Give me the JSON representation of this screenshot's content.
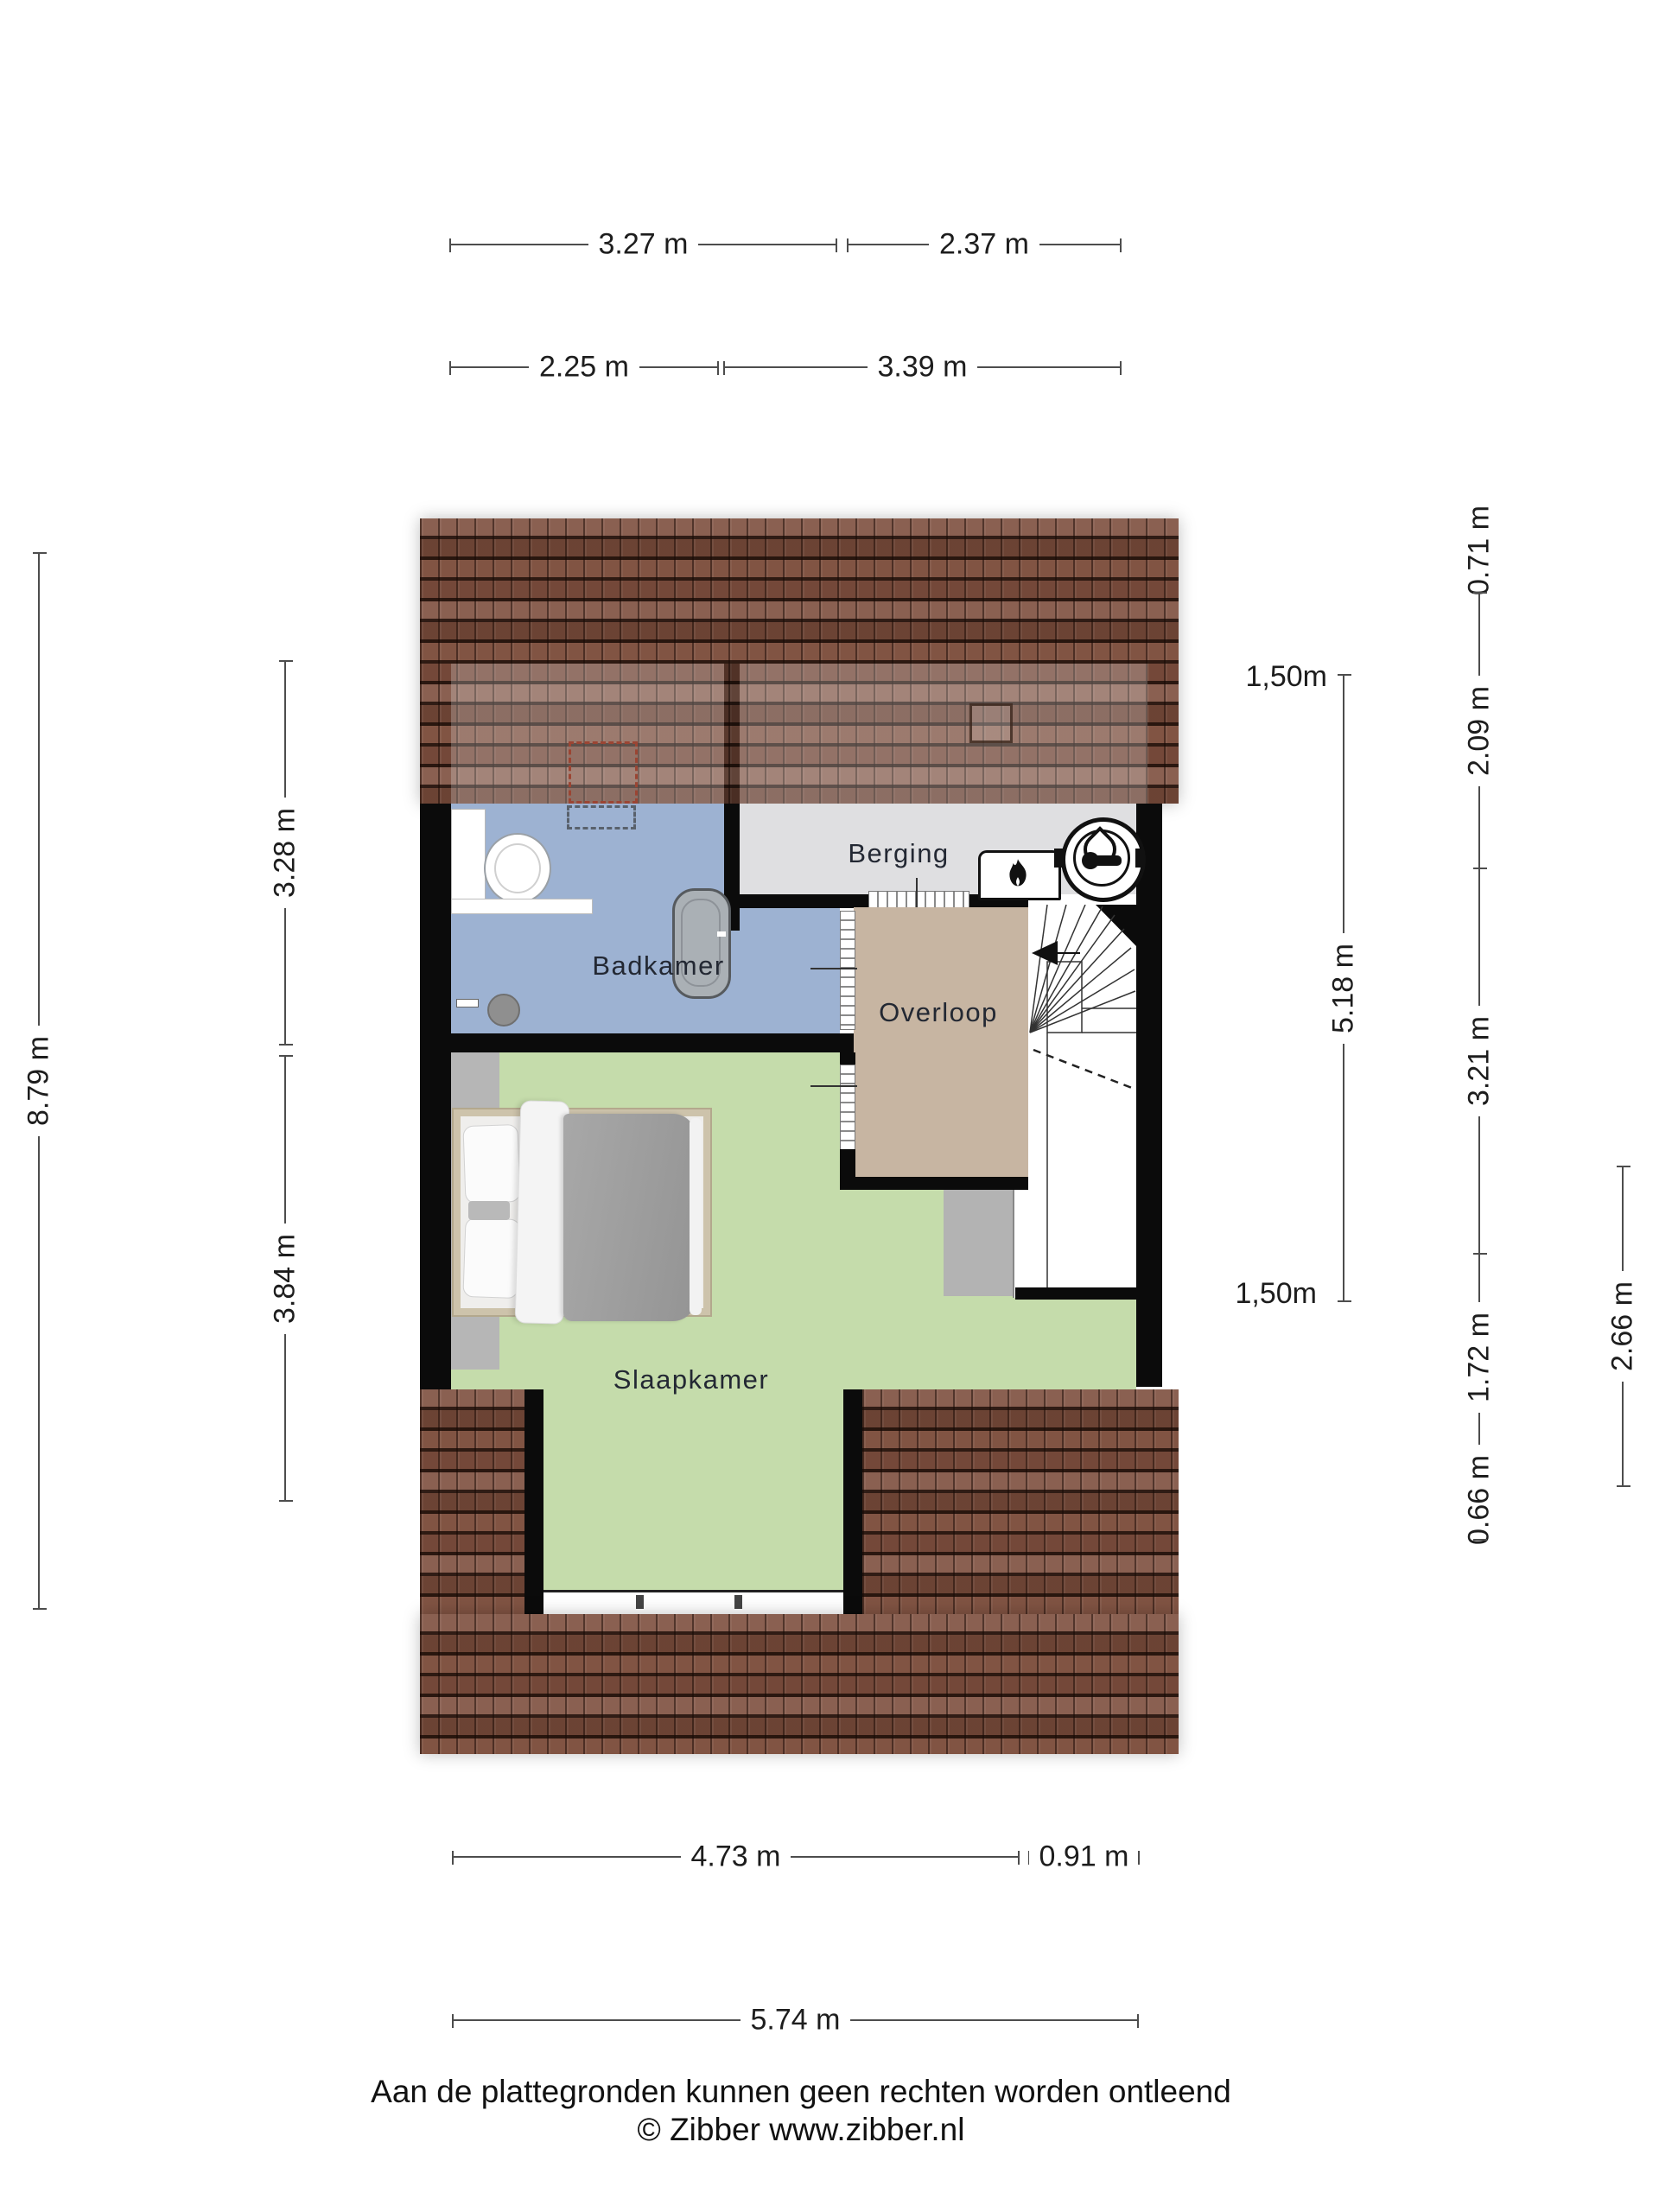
{
  "plan": {
    "rooms": {
      "badkamer": "Badkamer",
      "berging": "Berging",
      "overloop": "Overloop",
      "slaapkamer": "Slaapkamer"
    },
    "icons": [
      "flame-icon",
      "boiler-icon",
      "toilet-icon",
      "bathtub-icon",
      "shower-icon",
      "bed",
      "stairs",
      "roof-window",
      "skylight"
    ]
  },
  "dimensions": {
    "top1a": "3.27 m",
    "top1b": "2.37 m",
    "top2a": "2.25 m",
    "top2b": "3.39 m",
    "left_outer": "8.79 m",
    "left_inner_top": "3.28 m",
    "left_inner_bottom": "3.84 m",
    "right_marker_top": "1,50m",
    "right_marker_bottom": "1,50m",
    "right_span": "5.18 m",
    "right_col_1": "0.71 m",
    "right_col_2": "2.09 m",
    "right_col_3": "3.21 m",
    "right_col_4": "1.72 m",
    "right_col_5": "0.66 m",
    "right_outer": "2.66 m",
    "bottom1a": "4.73 m",
    "bottom1b": "0.91 m",
    "bottom2": "5.74 m"
  },
  "footer": {
    "line1": "Aan de plattegronden kunnen geen rechten worden ontleend",
    "line2": "© Zibber www.zibber.nl"
  },
  "colors": {
    "roof_base": "#7d4e3d",
    "wall": "#0b0b0b",
    "badkamer": "#9db2d2",
    "slaapkamer": "#c5dcab",
    "overloop": "#c7b5a2",
    "berging": "#dfdfe1",
    "sloped_gray": "#b6b6b6",
    "patch_gray": "#b3b3b3",
    "dim": "#4d4d4d",
    "text": "#232833"
  }
}
